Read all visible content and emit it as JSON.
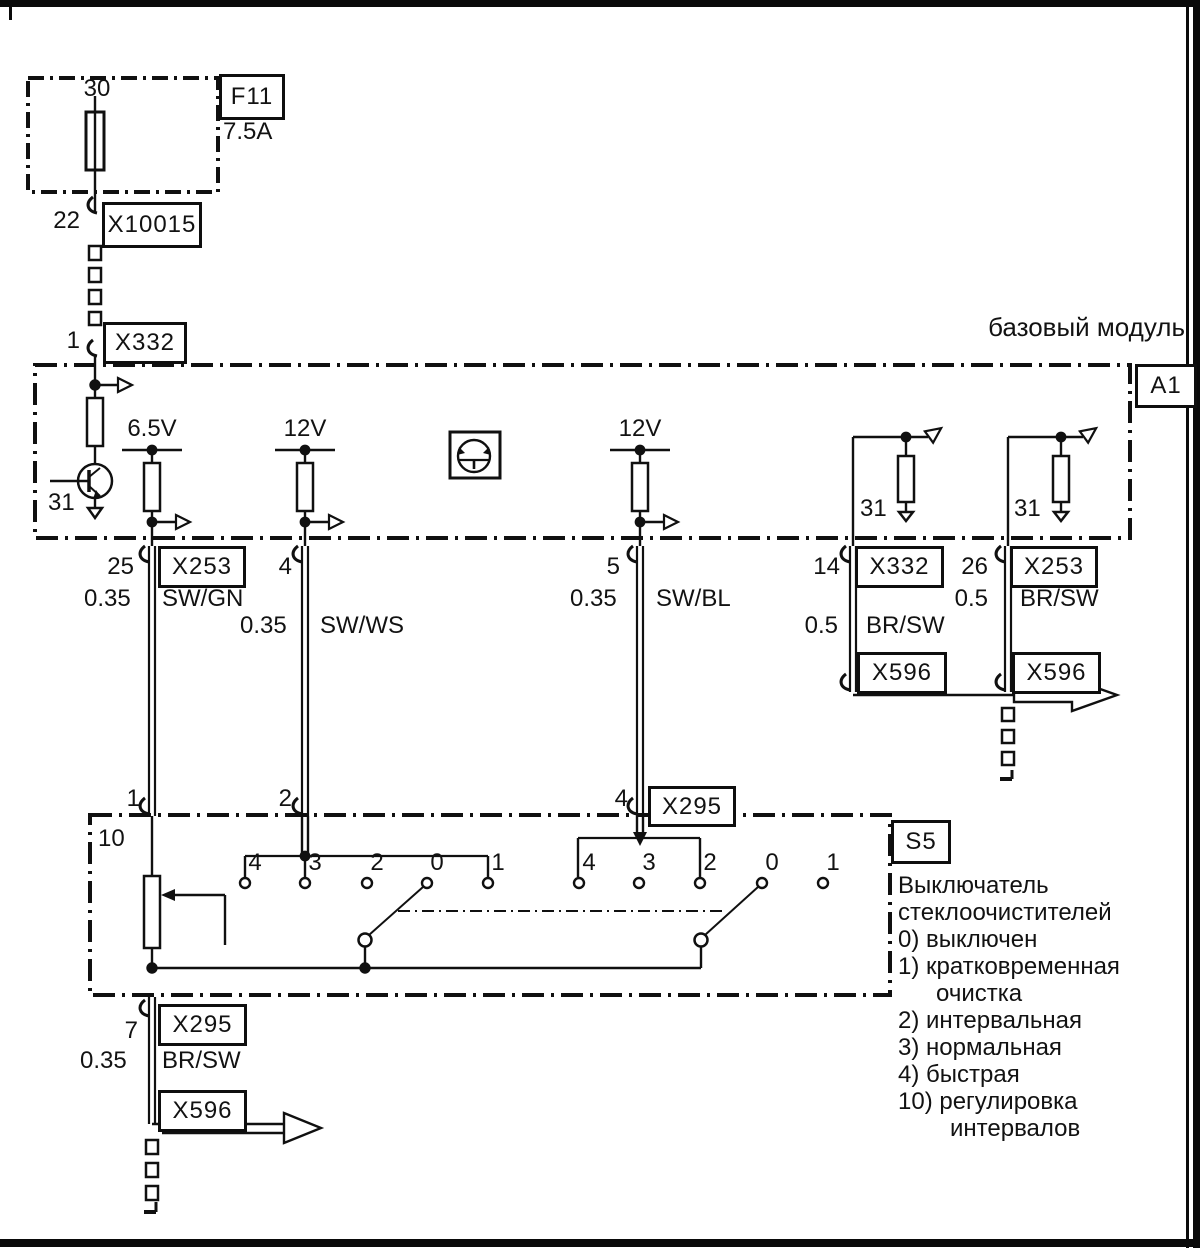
{
  "top": {
    "fuse_pin": "30",
    "fuse_id": "F11",
    "fuse_rating": "7.5A",
    "pin22": "22",
    "x10015": "X10015",
    "pin1": "1",
    "x332": "X332"
  },
  "module": {
    "title": "базовый модуль",
    "id": "A1",
    "transistor_ground": "31",
    "rail1": "6.5V",
    "rail2": "12V",
    "rail3": "12V",
    "ground1": "31",
    "ground2": "31"
  },
  "harness": {
    "w25": {
      "pin": "25",
      "conn": "X253",
      "gauge": "0.35",
      "color": "SW/GN"
    },
    "w4": {
      "pin": "4",
      "gauge": "0.35",
      "color": "SW/WS"
    },
    "w5": {
      "pin": "5",
      "gauge": "0.35",
      "color": "SW/BL"
    },
    "w14": {
      "pin": "14",
      "conn": "X332",
      "gauge": "0.5",
      "color": "BR/SW",
      "conn2": "X596"
    },
    "w26": {
      "pin": "26",
      "conn": "X253",
      "gauge": "0.5",
      "color": "BR/SW",
      "conn2": "X596"
    },
    "w7": {
      "pin": "7",
      "conn": "X295",
      "gauge": "0.35",
      "color": "BR/SW",
      "conn2": "X596"
    }
  },
  "switch": {
    "id": "S5",
    "x295": "X295",
    "pin_in1": "1",
    "pin_in2": "2",
    "pin_in4": "4",
    "pot_pin": "10",
    "g1": [
      "4",
      "3",
      "2",
      "0",
      "1"
    ],
    "g2": [
      "4",
      "3",
      "2",
      "0",
      "1"
    ]
  },
  "legend": {
    "lines": [
      "Выключатель",
      "стеклоочистителей",
      "0) выключен",
      "1) кратковременная",
      "очистка",
      "2) интервальная",
      "3) нормальная",
      "4) быстрая",
      "10) регулировка",
      "интервалов"
    ]
  }
}
